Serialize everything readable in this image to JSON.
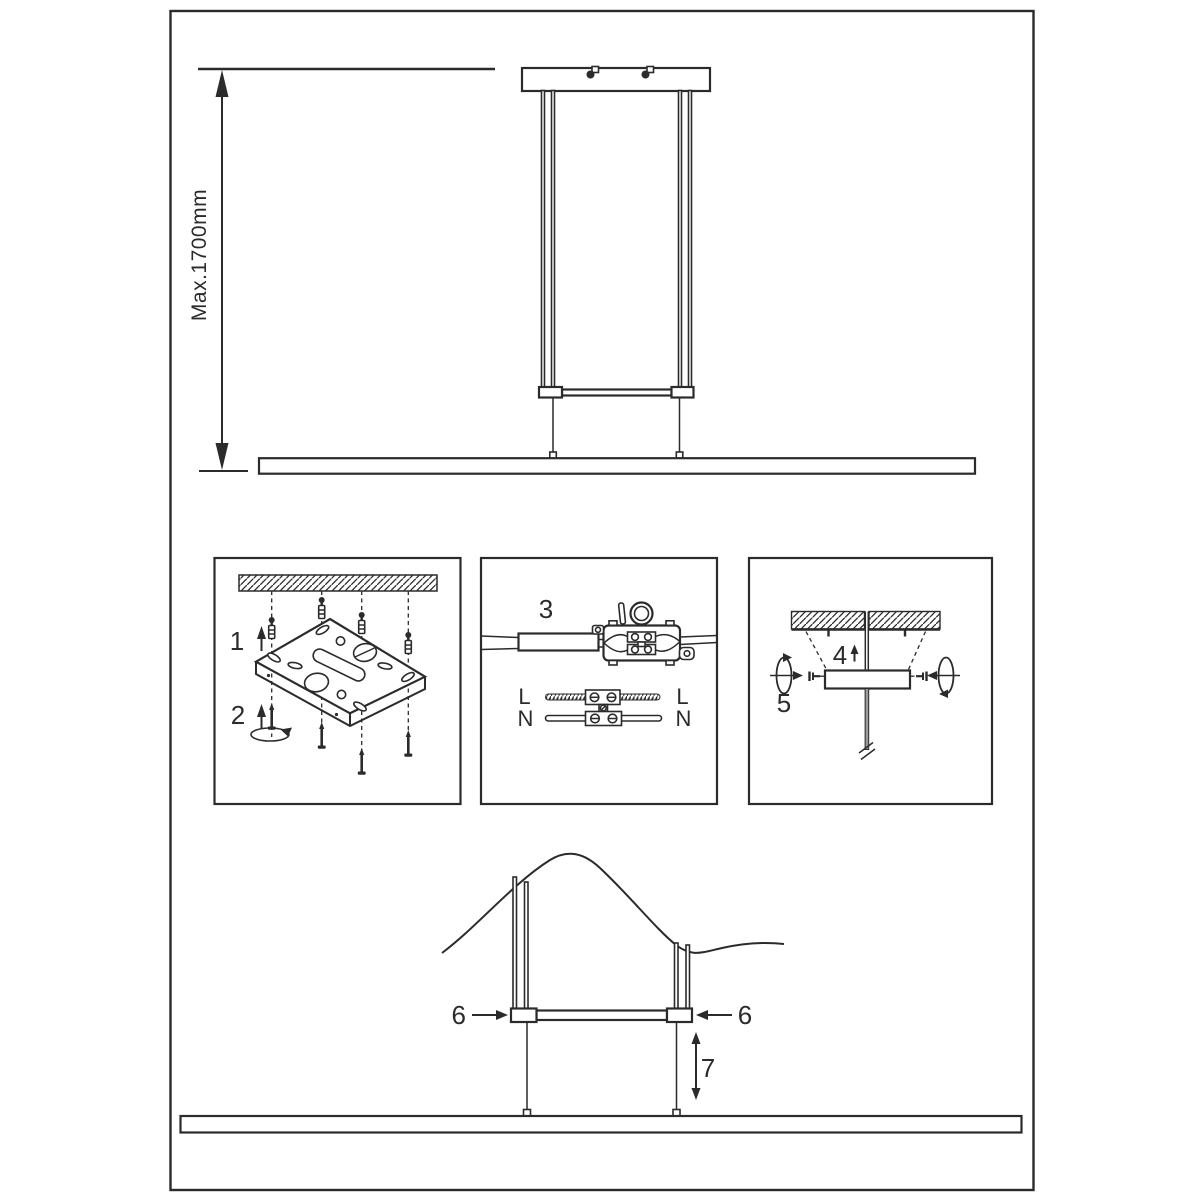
{
  "sheet": {
    "kind": "pendant-lamp installation instruction diagram",
    "background_color": "#ffffff",
    "line_color": "#2b2b2b",
    "hatch_color": "#2b2b2b"
  },
  "dimension": {
    "max_drop_label": "Max.1700mm"
  },
  "step_labels": {
    "step1": "1",
    "step2": "2",
    "step3": "3",
    "step4": "4",
    "step5": "5",
    "step6_left": "6",
    "step6_right": "6",
    "step7": "7"
  },
  "wiring_labels": {
    "live_left": "L",
    "live_right": "L",
    "neutral_left": "N",
    "neutral_right": "N"
  }
}
